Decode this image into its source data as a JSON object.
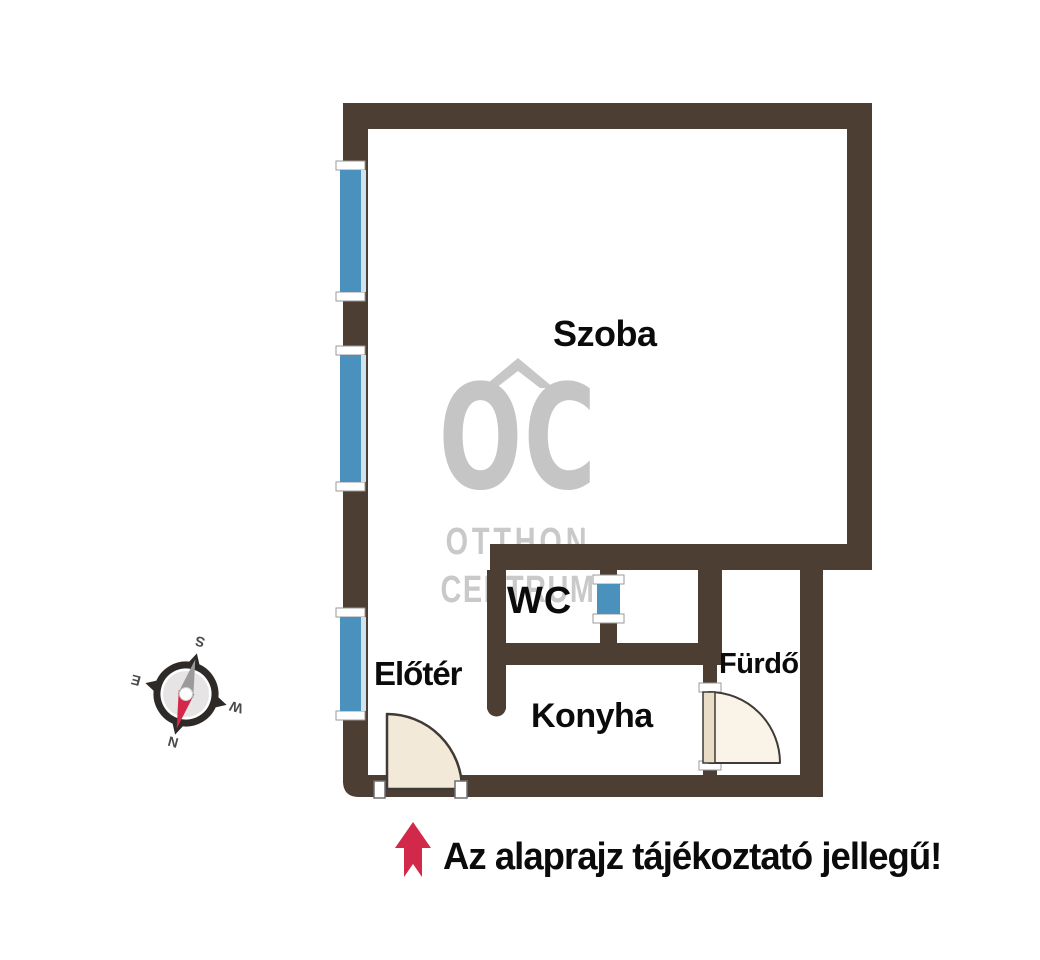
{
  "rooms": {
    "szoba": "Szoba",
    "wc": "WC",
    "eloter": "Előtér",
    "konyha": "Konyha",
    "furdo": "Fürdő"
  },
  "watermark": {
    "logo": "OC",
    "line1": "OTTHON",
    "line2": "CENTRUM"
  },
  "compass": {
    "north": "N",
    "east": "E",
    "south": "S",
    "west": "W"
  },
  "disclaimer": "Az alaprajz tájékoztató jellegű!",
  "colors": {
    "wall": "#4c3e33",
    "window": "#4a92bd",
    "window_sill": "#cfe2ee",
    "door_fill": "#f2e9d8",
    "accent_red": "#d2294b",
    "watermark_gray": "#c7c7c7"
  }
}
